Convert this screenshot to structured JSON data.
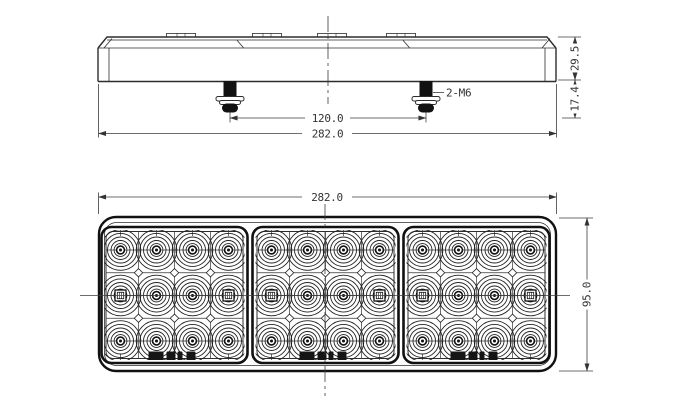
{
  "drawing": {
    "type": "technical-drawing",
    "subject": "triple-pod LED rear combination lamp",
    "views": {
      "top": "side-profile-with-mounting-studs",
      "bottom": "front-lens-face"
    }
  },
  "dimensions": {
    "side_overall_width": "282.0",
    "side_bolt_spacing": "120.0",
    "side_total_height": "29.5",
    "side_stud_protrusion": "17.4",
    "side_bolt_spec": "2-M6",
    "front_overall_width": "282.0",
    "front_overall_height": "95.0"
  },
  "lamp": {
    "pod_count": 3,
    "led_rows_per_pod": 3,
    "led_cols_per_pod": 4,
    "leds_per_pod": 12,
    "total_leds": 36,
    "mounting_studs": 2,
    "stud_thread": "M6"
  },
  "colors": {
    "line": "#2d2d2d",
    "dim_line": "#3c3c3c",
    "background": "#ffffff",
    "solid_fill": "#111111"
  }
}
